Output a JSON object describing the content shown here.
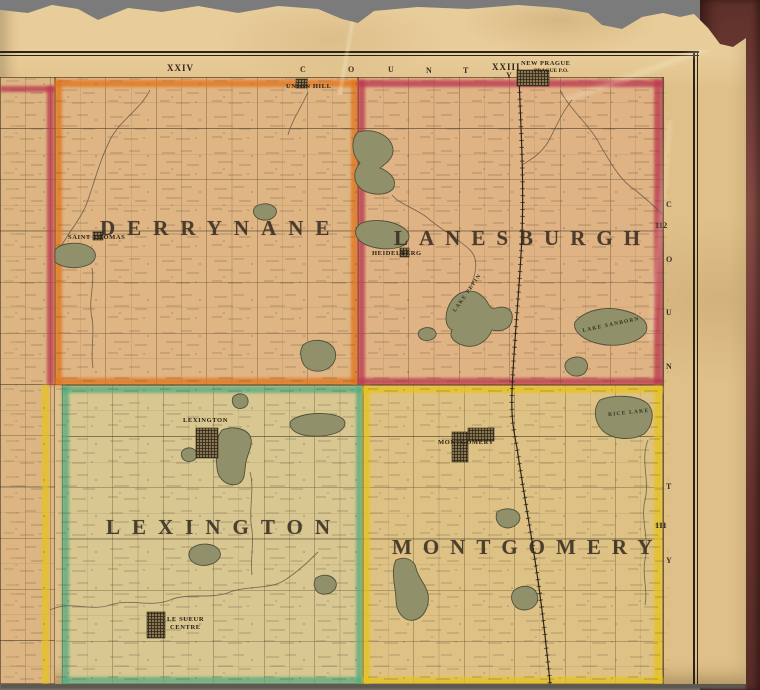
{
  "map": {
    "townships": {
      "derrynane": {
        "name": "DERRYNANE",
        "border_color": "#e2761e"
      },
      "lanesburgh": {
        "name": "LANESBURGH",
        "border_color": "#bc3a52"
      },
      "lexington": {
        "name": "LEXINGTON",
        "border_color": "#58ab80"
      },
      "montgomery": {
        "name": "MONTGOMERY",
        "border_color": "#e6c31f"
      }
    },
    "villages": {
      "saint_thomas": "SAINT THOMAS",
      "union_hill": "UNION HILL",
      "heidelberg": "HEIDELBERG",
      "lexington_village": "LEXINGTON",
      "montgomery_village": "MONTGOMERY",
      "le_sueur_centre_line1": "LE SUEUR",
      "le_sueur_centre_line2": "CENTRE"
    },
    "lakes": {
      "lake_pepin": "LAKE PEPIN",
      "lake_sanborn": "LAKE SANBORN",
      "rice_lake": "RICE LAKE"
    }
  },
  "margins": {
    "top": {
      "range_left": "XXIV",
      "range_right": "XXIII",
      "letters": [
        "C",
        "O",
        "U",
        "N",
        "T"
      ],
      "letter_y": "Y",
      "new_prague": "NEW PRAGUE",
      "prague_po": "PRAGUE P.O."
    },
    "right": {
      "township_number_upper": "112",
      "township_number_lower": "111",
      "letters": [
        "C",
        "O",
        "U",
        "N",
        "T",
        "Y"
      ]
    }
  },
  "palette": {
    "scan_background": "#7b7b7b",
    "book_cover": "#7d3f38",
    "paper": "#e0c089",
    "frame_line": "#2c2517",
    "lake_fill": "#90906a"
  }
}
